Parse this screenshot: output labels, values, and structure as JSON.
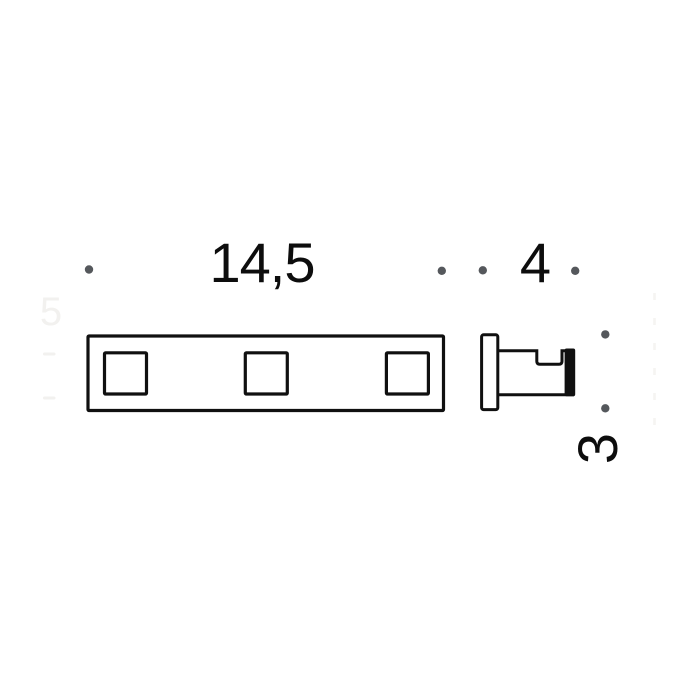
{
  "figure": {
    "kind": "technical-dimension-drawing"
  },
  "dimensions": [
    {
      "id": "rail-width",
      "label": "14,5",
      "orientation": "horizontal"
    },
    {
      "id": "hook-depth",
      "label": "4",
      "orientation": "horizontal"
    },
    {
      "id": "hook-height",
      "label": "3",
      "orientation": "vertical"
    }
  ],
  "watermark": {
    "ghost_label": "5"
  },
  "colors": {
    "line": "#101010",
    "text": "#0d0d0d",
    "dot": "#55585c",
    "background": "#ffffff",
    "ghost": "#f2f1ef"
  }
}
